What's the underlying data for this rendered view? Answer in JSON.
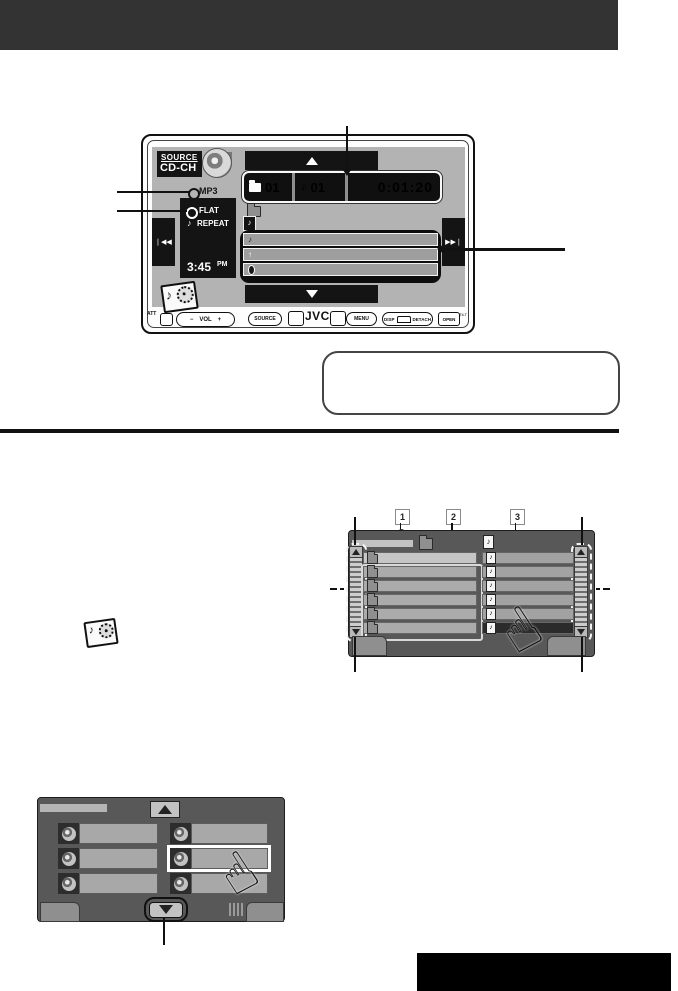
{
  "device_screen": {
    "source_label": "SOURCE",
    "source_value": "CD-CH",
    "format_indicator": "MP3",
    "sound_mode": "FLAT",
    "play_mode": "REPEAT",
    "clock": "3:45",
    "clock_suffix": "PM",
    "folder_number": "01",
    "track_number": "01",
    "elapsed_time": "0:01:20"
  },
  "front_panel": {
    "att": "ATT",
    "volume_minus": "−",
    "volume_label": "VOL",
    "volume_plus": "+",
    "source": "SOURCE",
    "brand": "JVC",
    "menu": "MENU",
    "disp": "DISP",
    "detach": "DETACH",
    "open": "OPEN",
    "tilt": "TILT"
  },
  "callout_labels": {
    "one": "1",
    "two": "2",
    "three": "3"
  },
  "icons": {
    "up_arrow": "▲",
    "down_arrow": "▼",
    "rewind": "◀◀",
    "forward": "▶▶",
    "note": "♪",
    "artist_arrow": "↑",
    "hand": "☝"
  },
  "colors": {
    "header_bar": "#333333",
    "screen_background": "#b3b3b3",
    "device_black": "#141414",
    "diagram_frame": "#585858",
    "footer_bar": "#000000"
  }
}
